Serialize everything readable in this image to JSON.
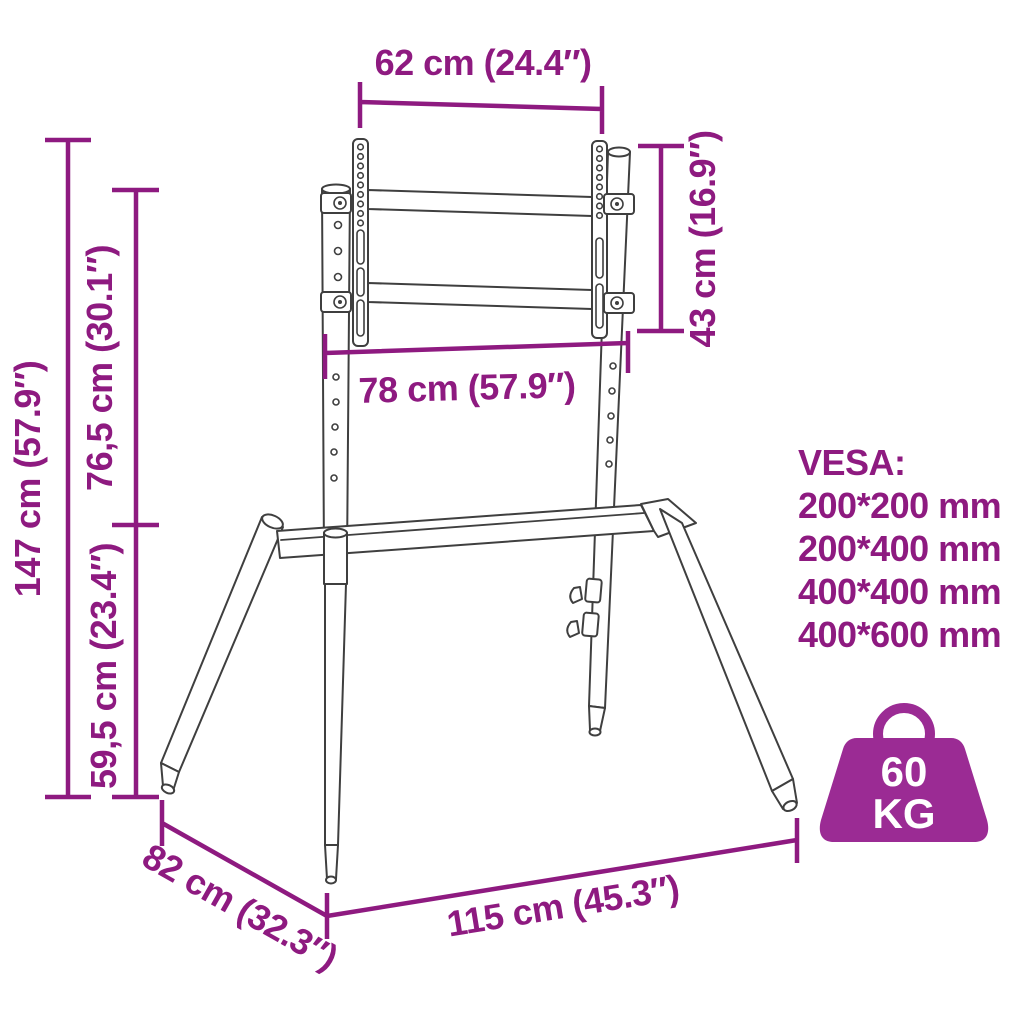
{
  "diagram": {
    "title": "tv-floor-stand-dimension-diagram",
    "dimensions": {
      "width_top": "62 cm (24.4″)",
      "bracket_height": "43 cm (16.9″)",
      "width_mid": "78 cm (57.9″)",
      "height_total": "147 cm (57.9″)",
      "height_upper": "76,5 cm (30.1″)",
      "height_lower": "59,5 cm (23.4″)",
      "depth": "82 cm (32.3″)",
      "width_base": "115 cm (45.3″)"
    },
    "vesa": {
      "title": "VESA:",
      "sizes": [
        "200*200 mm",
        "200*400 mm",
        "400*400 mm",
        "400*600 mm"
      ]
    },
    "max_load": {
      "value": "60",
      "unit": "KG"
    },
    "colors": {
      "annotation": "#8e1a80",
      "icon": "#9b2b94",
      "line_art": "#3f3f3f",
      "background": "#ffffff"
    }
  }
}
